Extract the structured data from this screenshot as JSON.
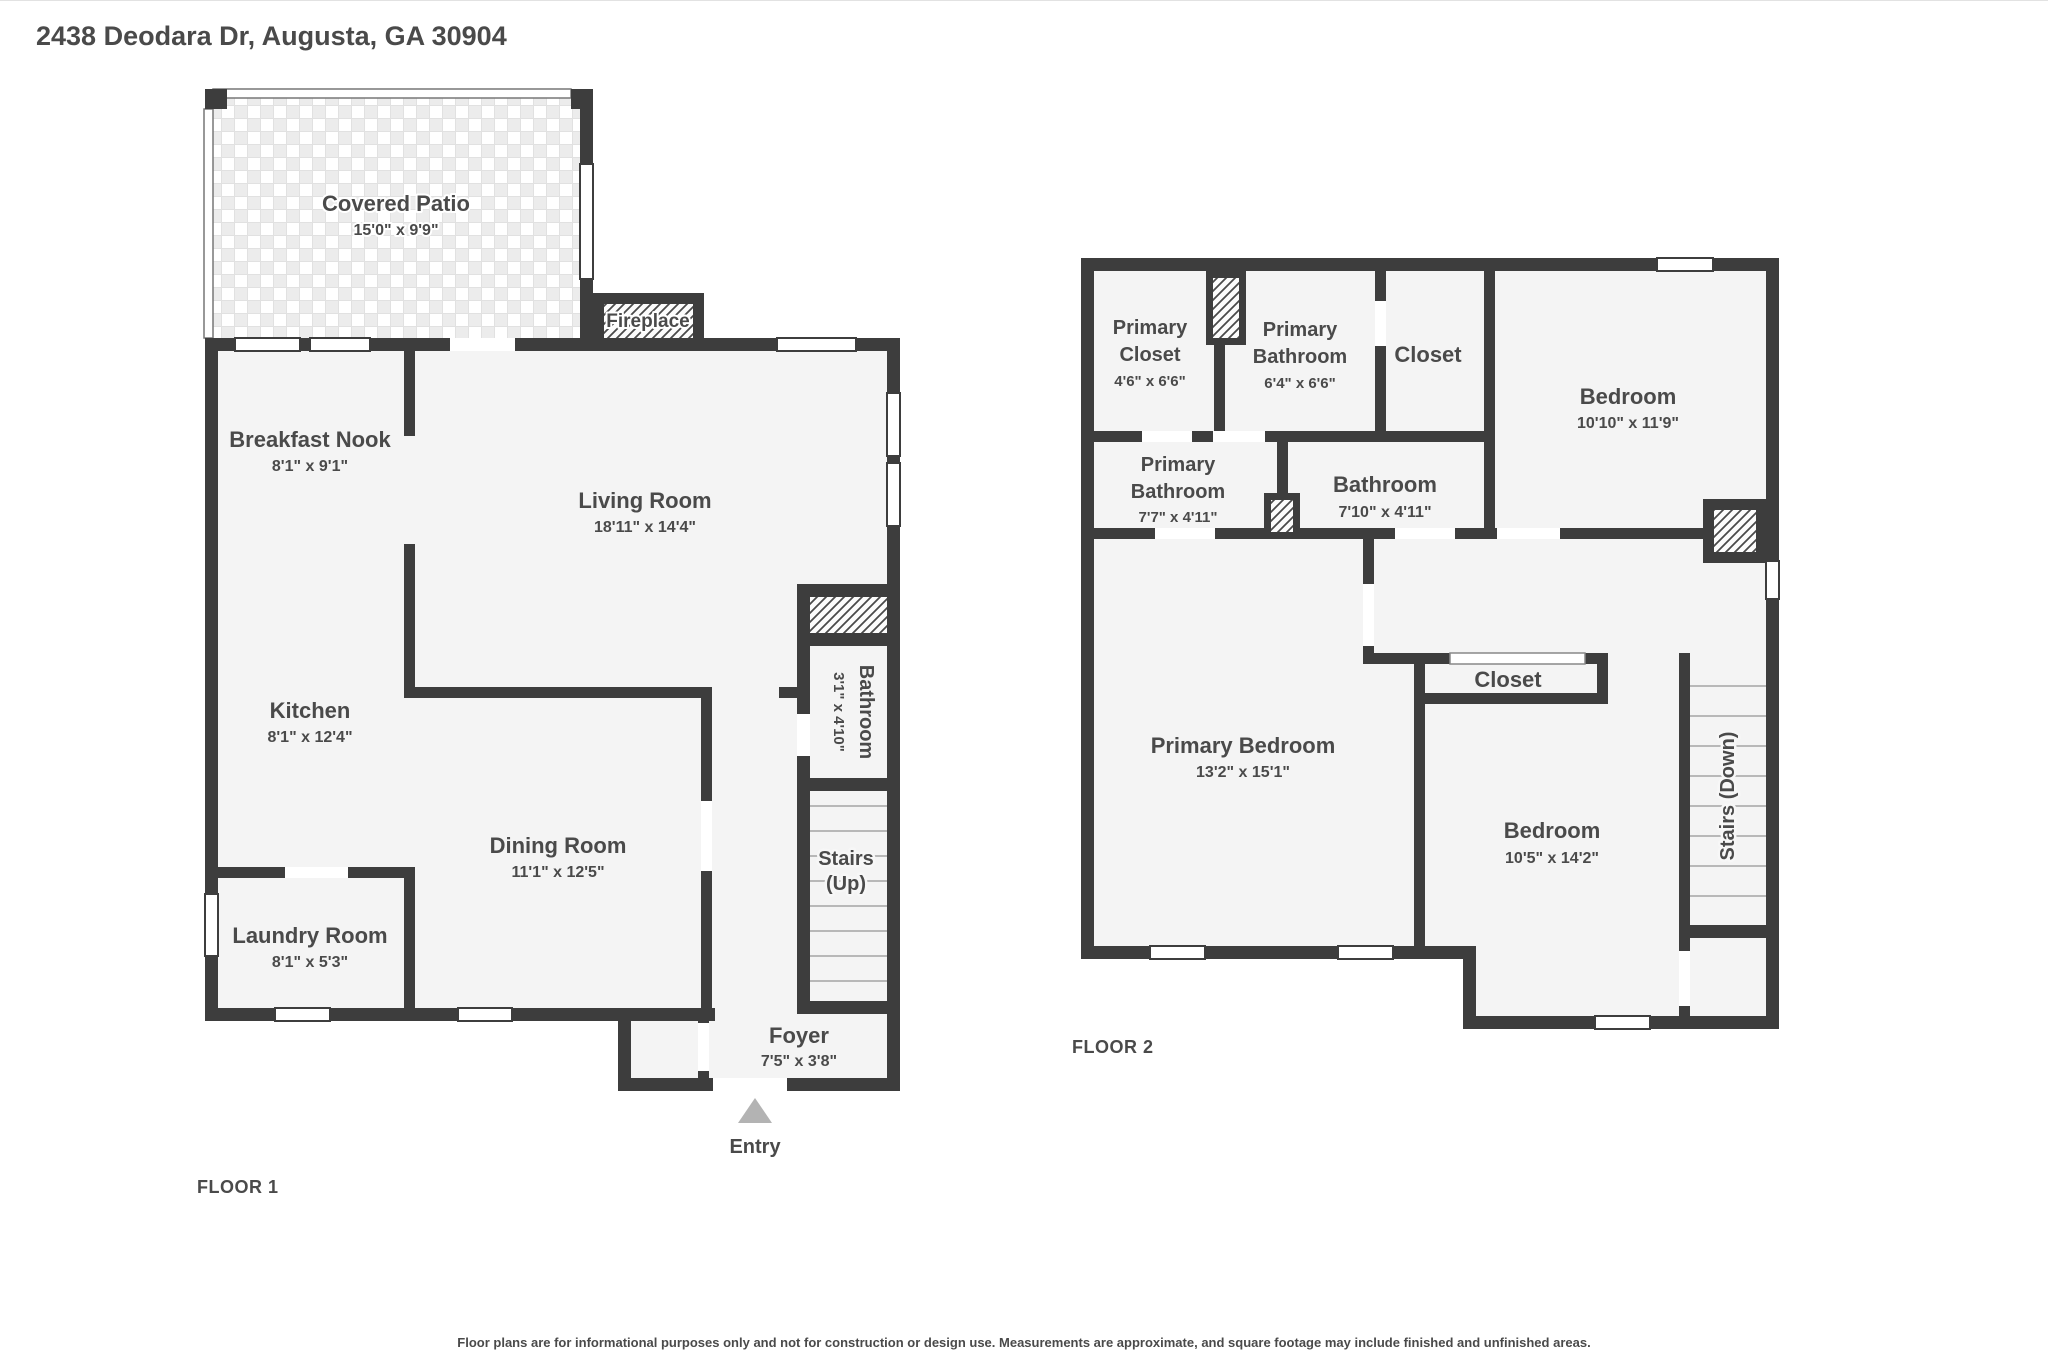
{
  "title": "2438 Deodara Dr, Augusta, GA 30904",
  "disclaimer": "Floor plans are for informational purposes only and not for construction or design use. Measurements are approximate, and square footage may include finished and unfinished areas.",
  "colors": {
    "wall": "#3d3d3d",
    "room_fill": "#f4f4f4",
    "text": "#4a4a4a",
    "entry_arrow": "#b3b3b3"
  },
  "floor1": {
    "label": "FLOOR 1",
    "entry_label": "Entry",
    "rooms": {
      "covered_patio": {
        "name": "Covered Patio",
        "dims": "15'0\" x 9'9\""
      },
      "fireplace": {
        "name": "Fireplace"
      },
      "breakfast_nook": {
        "name": "Breakfast Nook",
        "dims": "8'1\" x 9'1\""
      },
      "living_room": {
        "name": "Living Room",
        "dims": "18'11\" x 14'4\""
      },
      "kitchen": {
        "name": "Kitchen",
        "dims": "8'1\" x 12'4\""
      },
      "dining_room": {
        "name": "Dining Room",
        "dims": "11'1\" x 12'5\""
      },
      "laundry_room": {
        "name": "Laundry Room",
        "dims": "8'1\" x 5'3\""
      },
      "bathroom": {
        "name": "Bathroom",
        "dims": "3'1\" x 4'10\""
      },
      "stairs": {
        "name": "Stairs",
        "direction": "(Up)"
      },
      "foyer": {
        "name": "Foyer",
        "dims": "7'5\" x 3'8\""
      }
    }
  },
  "floor2": {
    "label": "FLOOR 2",
    "rooms": {
      "primary_closet": {
        "line1": "Primary",
        "line2": "Closet",
        "dims": "4'6\" x 6'6\""
      },
      "primary_bathroom_upper": {
        "line1": "Primary",
        "line2": "Bathroom",
        "dims": "6'4\" x 6'6\""
      },
      "closet_upper": {
        "name": "Closet"
      },
      "bedroom_upper": {
        "name": "Bedroom",
        "dims": "10'10\" x 11'9\""
      },
      "primary_bathroom": {
        "line1": "Primary",
        "line2": "Bathroom",
        "dims": "7'7\" x 4'11\""
      },
      "bathroom": {
        "name": "Bathroom",
        "dims": "7'10\" x 4'11\""
      },
      "closet": {
        "name": "Closet"
      },
      "primary_bedroom": {
        "name": "Primary Bedroom",
        "dims": "13'2\" x 15'1\""
      },
      "bedroom": {
        "name": "Bedroom",
        "dims": "10'5\" x 14'2\""
      },
      "stairs": {
        "name": "Stairs (Down)"
      }
    }
  }
}
